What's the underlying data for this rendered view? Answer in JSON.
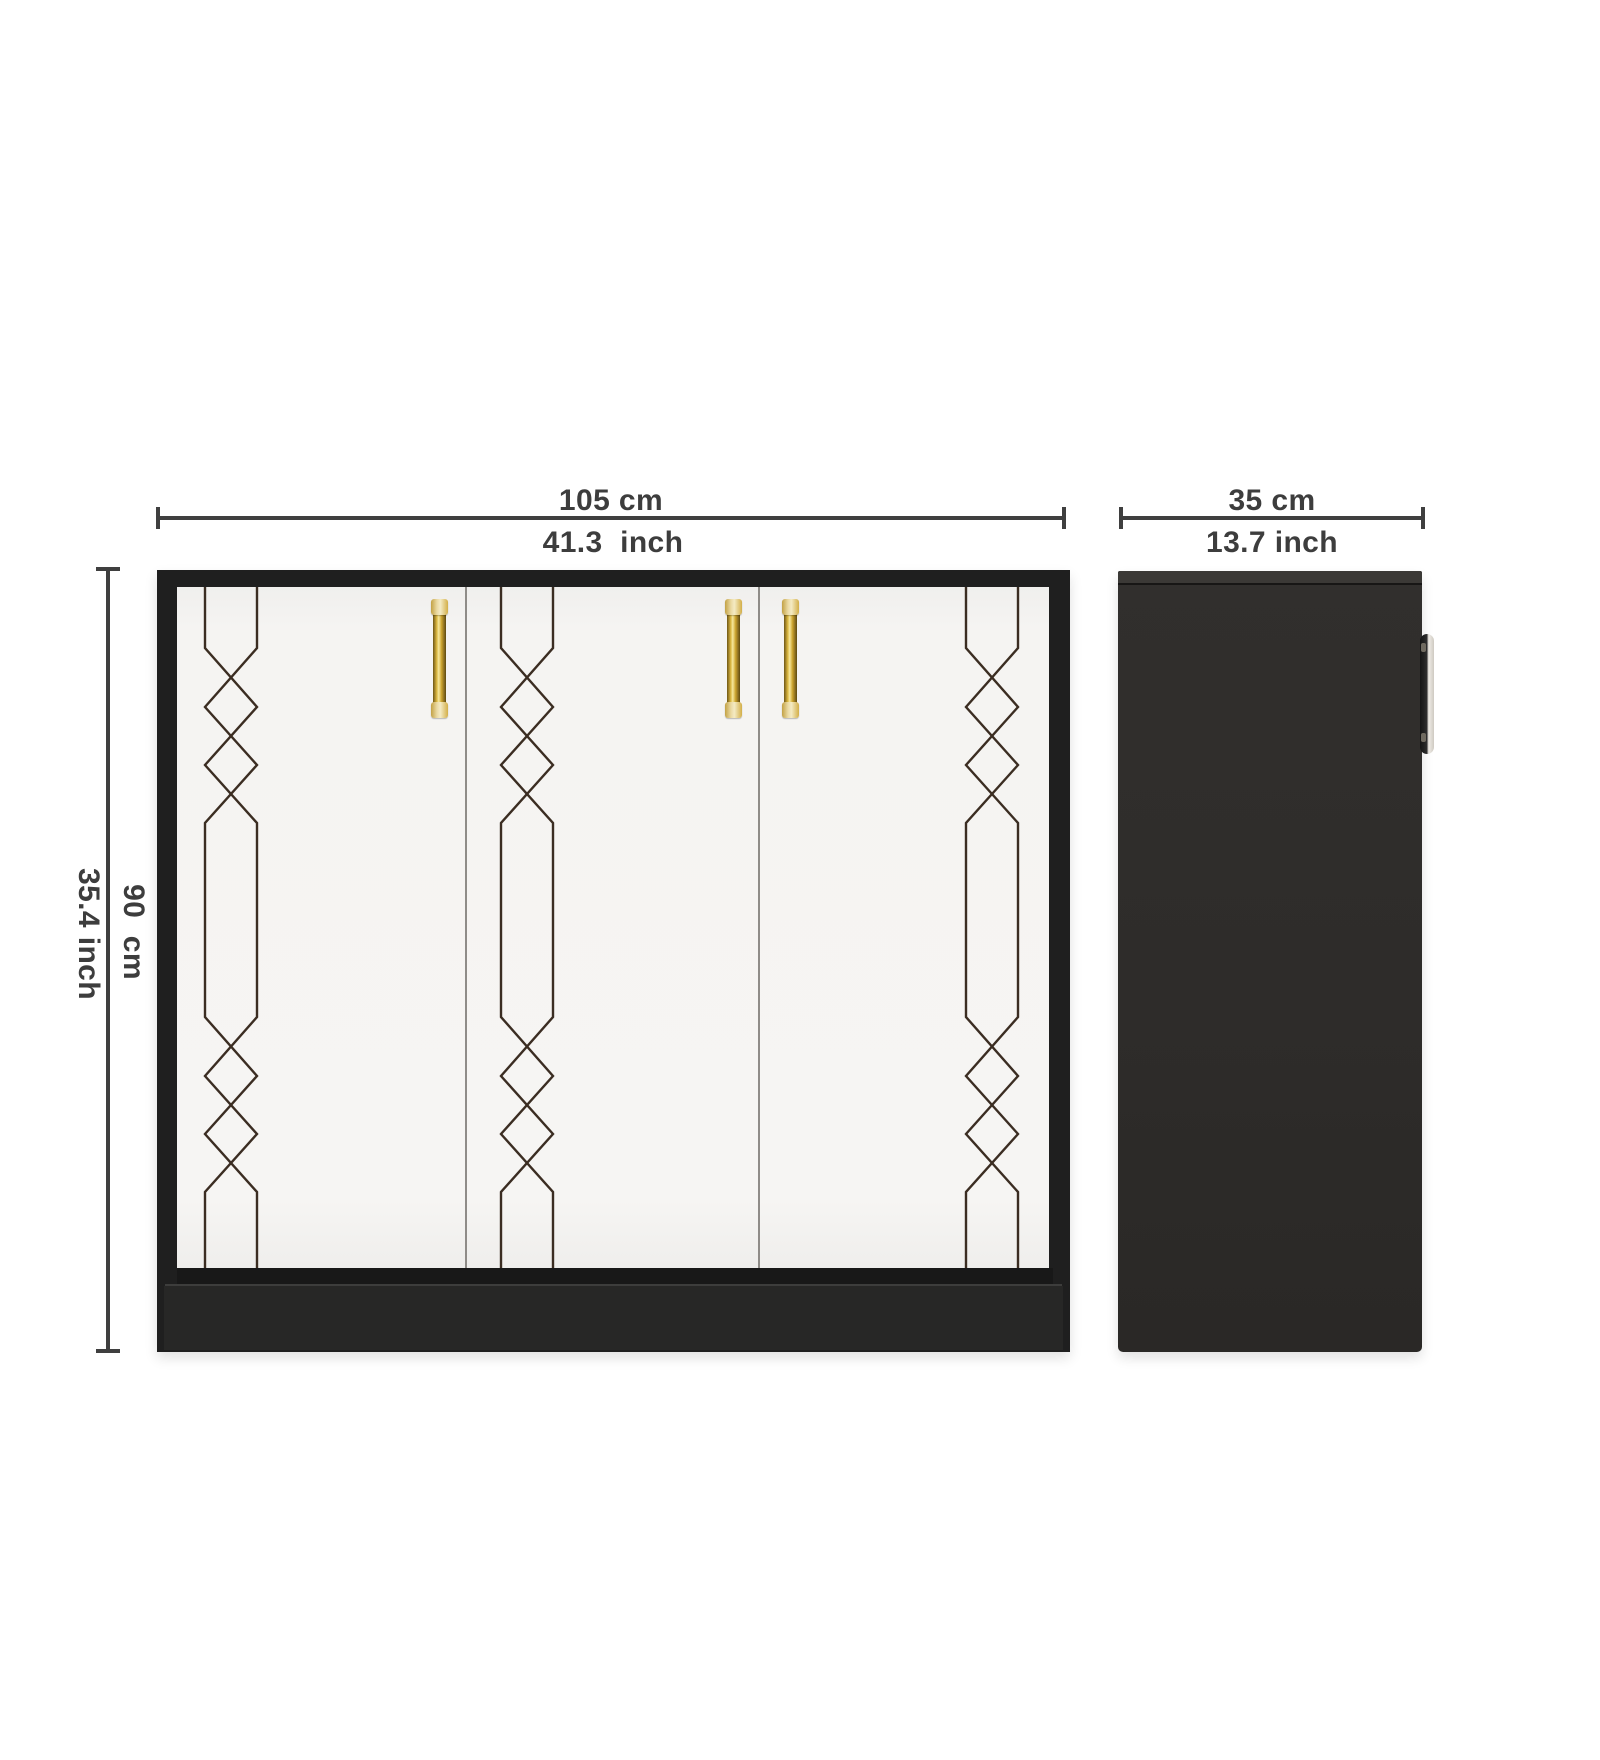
{
  "diagram": {
    "front_view": {
      "width_cm": "105 cm",
      "width_inch": "41.3  inch",
      "height_cm": "90  cm",
      "height_inch": "35.4 inch",
      "door_count": 3,
      "pattern": "art-deco diamond chain inlay"
    },
    "side_view": {
      "depth_cm": "35 cm",
      "depth_inch": "13.7 inch"
    },
    "colors": {
      "cabinet_black": "#1f1f1f",
      "side_panel": "#2e2c2a",
      "door_white": "#f5f4f2",
      "pattern_line": "#3b2d22",
      "dimension_gray": "#3f3f3f",
      "handle_gold": "#d9b53f"
    }
  }
}
